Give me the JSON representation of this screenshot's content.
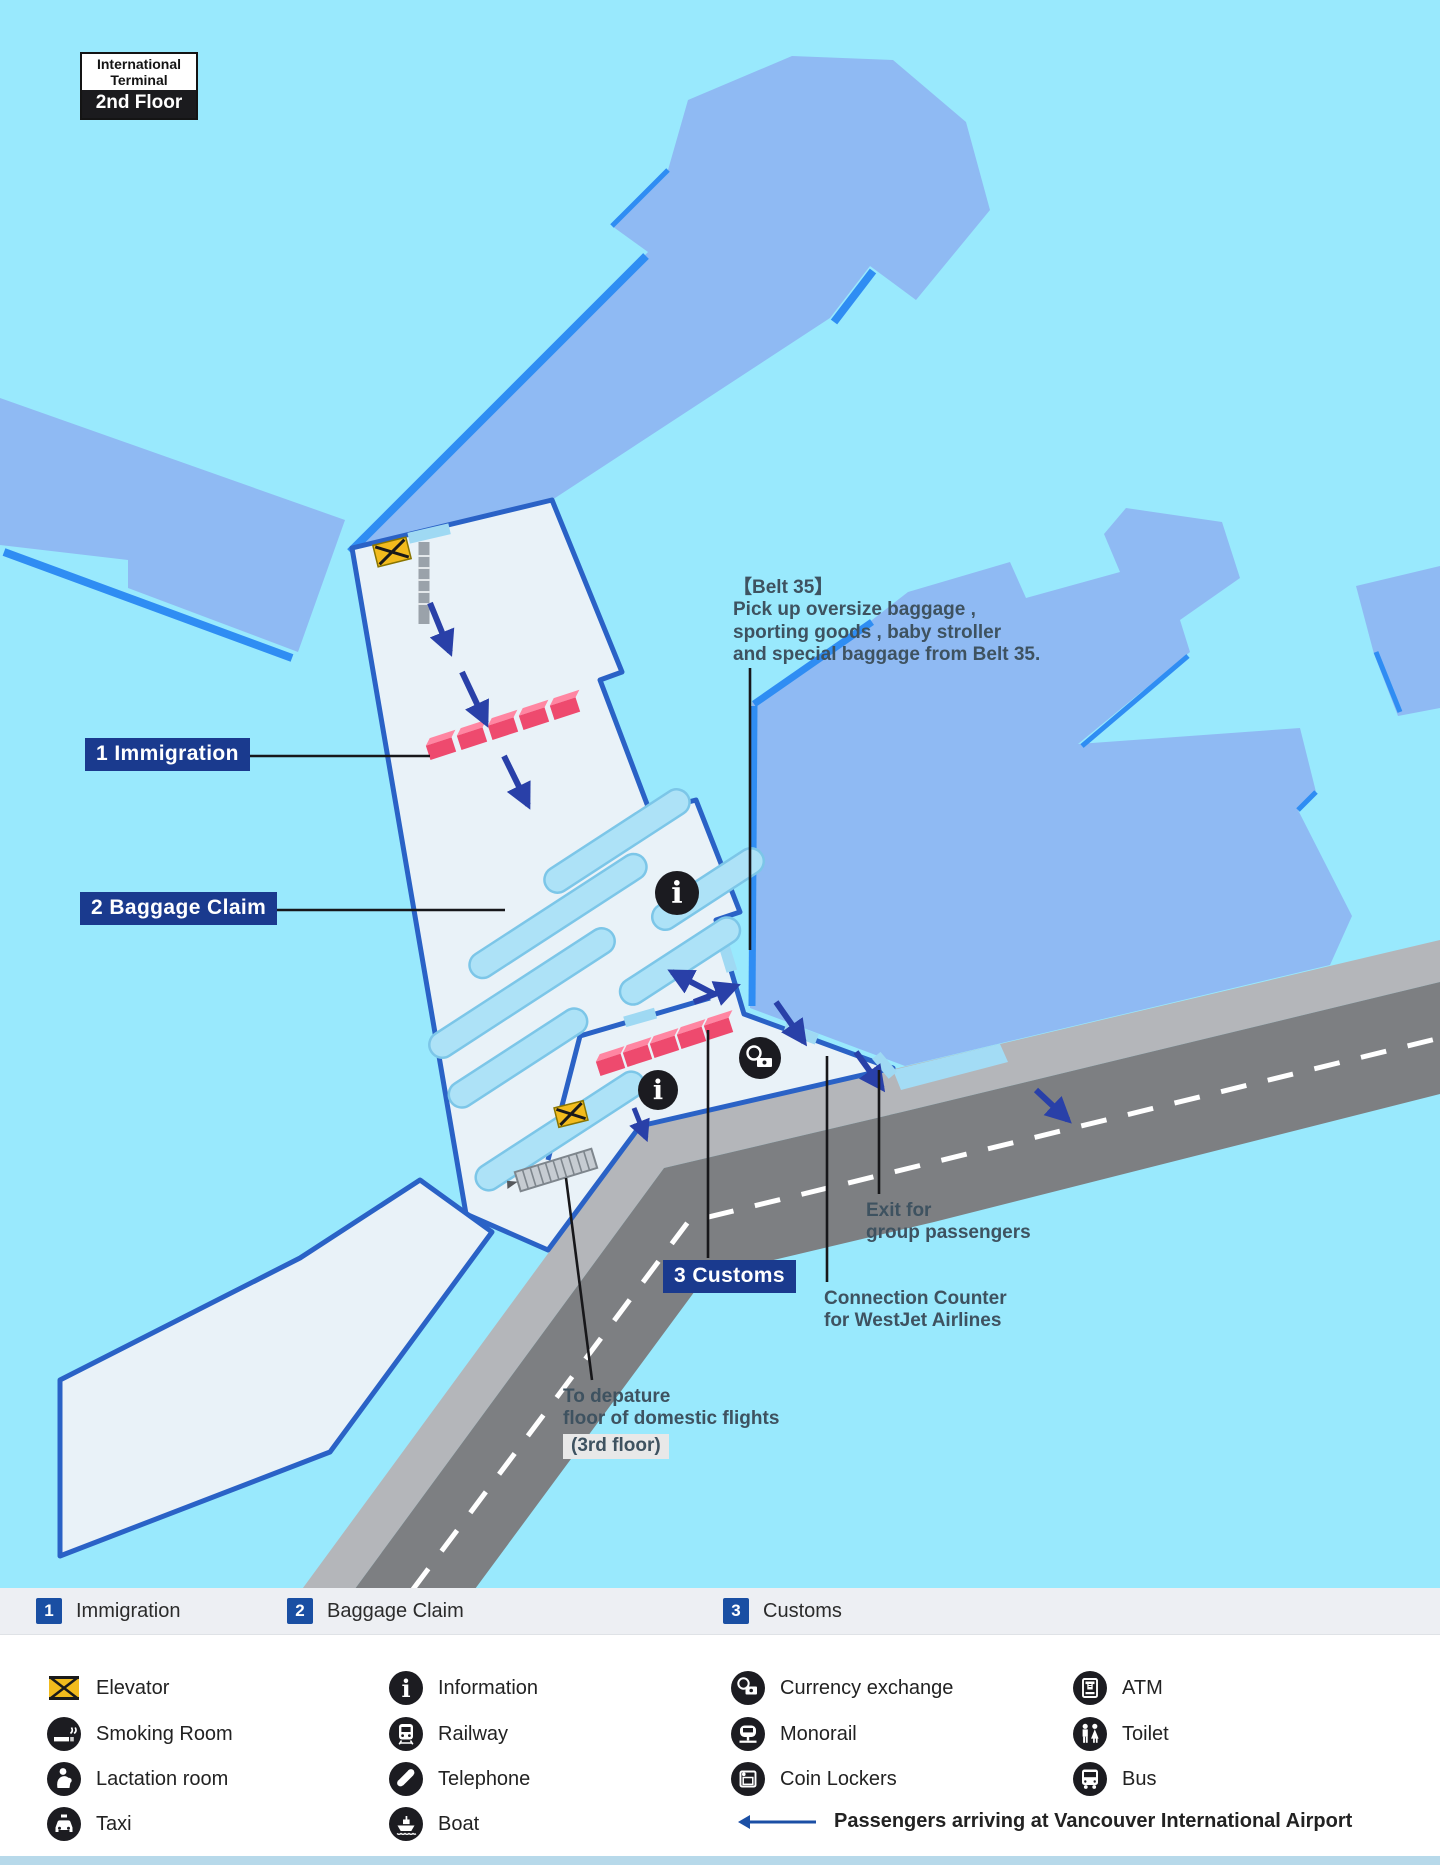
{
  "title_badge": {
    "line1": "International",
    "line2": "Terminal",
    "floor": "2nd Floor"
  },
  "map_labels": {
    "immigration": "1 Immigration",
    "baggage_claim": "2 Baggage Claim",
    "customs": "3 Customs"
  },
  "annotations": {
    "belt35_title": "【Belt 35】",
    "belt35_line1": "Pick up oversize baggage ,",
    "belt35_line2": "sporting goods , baby stroller",
    "belt35_line3": "and special baggage from Belt 35.",
    "exit_group_line1": "Exit for",
    "exit_group_line2": "group passengers",
    "connection_line1": "Connection Counter",
    "connection_line2": "for WestJet Airlines",
    "departure_line1": "To depature",
    "departure_line2": "floor of domestic flights",
    "departure_floor_chip": "(3rd floor)"
  },
  "legend_numbered": [
    {
      "num": "1",
      "label": "Immigration"
    },
    {
      "num": "2",
      "label": "Baggage Claim"
    },
    {
      "num": "3",
      "label": "Customs"
    }
  ],
  "legend_facilities": [
    {
      "icon": "elevator-icon",
      "label": "Elevator"
    },
    {
      "icon": "smoking-room-icon",
      "label": "Smoking Room"
    },
    {
      "icon": "lactation-room-icon",
      "label": "Lactation room"
    },
    {
      "icon": "taxi-icon",
      "label": "Taxi"
    },
    {
      "icon": "information-icon",
      "label": "Information"
    },
    {
      "icon": "railway-icon",
      "label": "Railway"
    },
    {
      "icon": "telephone-icon",
      "label": "Telephone"
    },
    {
      "icon": "boat-icon",
      "label": "Boat"
    },
    {
      "icon": "currency-exchange-icon",
      "label": "Currency exchange"
    },
    {
      "icon": "monorail-icon",
      "label": "Monorail"
    },
    {
      "icon": "coin-lockers-icon",
      "label": "Coin Lockers"
    },
    {
      "icon": "atm-icon",
      "label": "ATM"
    },
    {
      "icon": "toilet-icon",
      "label": "Toilet"
    },
    {
      "icon": "bus-icon",
      "label": "Bus"
    }
  ],
  "arrow_note": "Passengers arriving at Vancouver International Airport",
  "icons": {
    "info_glyph": "i"
  },
  "colors": {
    "map_background": "#99e9fd",
    "pier_fill": "#8fbaf3",
    "pier_edge": "#2f8df3",
    "floor_fill": "#e9f2f8",
    "wall": "#2a62c6",
    "belt_fill": "#ade2f7",
    "counter_pink": "#ee4a6e",
    "arrow_navy": "#2940a8",
    "road_dark": "#7d7f82",
    "sidewalk_gray": "#b4b6ba",
    "label_navy": "#1a3a8e",
    "legend_band": "#edeff3",
    "number_blue": "#1a4fa3",
    "icon_black": "#1c1c21",
    "elevator_yellow": "#f2bb1d",
    "bottom_strip": "#b7d9ea"
  }
}
